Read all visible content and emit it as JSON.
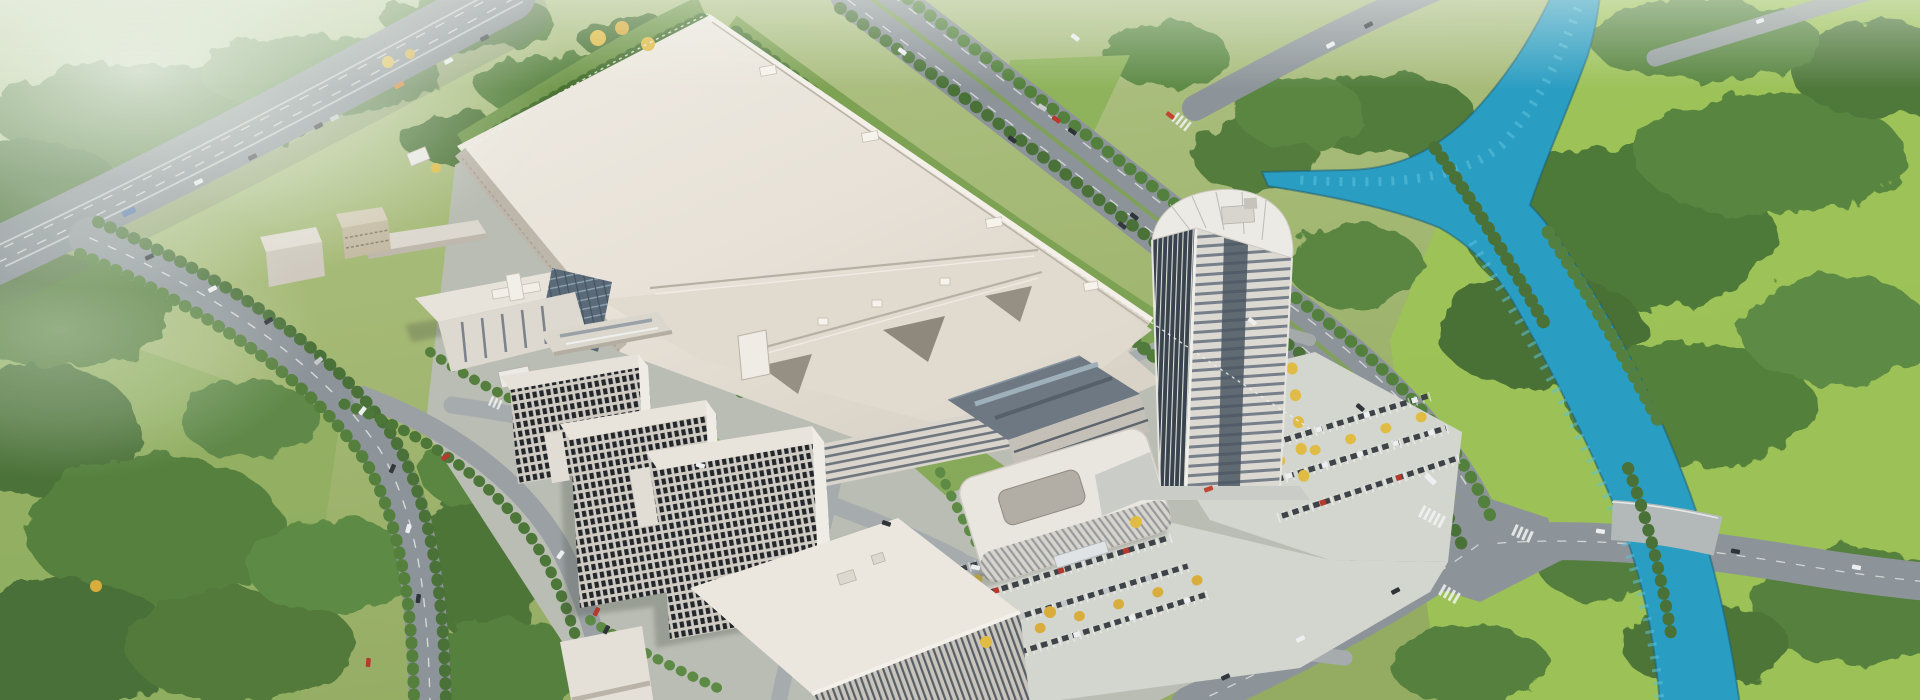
{
  "scene": {
    "kind": "aerial-architectural-rendering",
    "description": "Bird's-eye 3D visualization of an industrial campus: a huge white factory hall, a curved-top office tower, R&D buildings, dormitory slabs, parking lots with autumn trees, perimeter roads, an elevated highway at the upper left, green fields, dense forests and a turquoise river with a Y-junction on the right.",
    "visible_text": "none",
    "width_px": 1920,
    "height_px": 700
  },
  "palette": {
    "grass_base": "#a9bc7d",
    "lawn_bright": "#9cc355",
    "forest_dark": "#466f35",
    "forest_mid": "#527c3c",
    "forest_light": "#628f46",
    "asphalt": "#8d9499",
    "highway": "#848b91",
    "internal_road": "#a6abae",
    "river_water": "#2a9dc2",
    "river_highlight": "#5cc3dc",
    "roof_light": "#ece7df",
    "roof_warm": "#e2dcd2",
    "facade_shade": "#b9b3a8",
    "dark_roof": "#6d7883",
    "tower_glass": "#38434e",
    "window_dark": "#23272c",
    "pavement": "#c6c9c4",
    "parking_ground": "#d3d5cf",
    "car_dark": "#34393e",
    "car_white": "#eceeef",
    "car_red": "#b7382c",
    "car_orange": "#d9822b",
    "tree_yellow": "#e0bc45",
    "haze": "#eef4ec"
  },
  "inventory": {
    "landmarks": [
      "elevated-highway",
      "left-perimeter-road",
      "northeast-avenue",
      "service-road",
      "river",
      "river-pool-junction",
      "main-factory-hall",
      "factory-south-halls",
      "office-tower",
      "rounded-office-building",
      "rnd-building",
      "lab-annex",
      "dormitory-blocks",
      "bottom-logistics-building",
      "parking-lots",
      "small-campus-buildings",
      "forest-patches",
      "right-lawn",
      "intersection-southeast"
    ],
    "parking_car_rows": 7,
    "dormitory_blocks": 3
  }
}
